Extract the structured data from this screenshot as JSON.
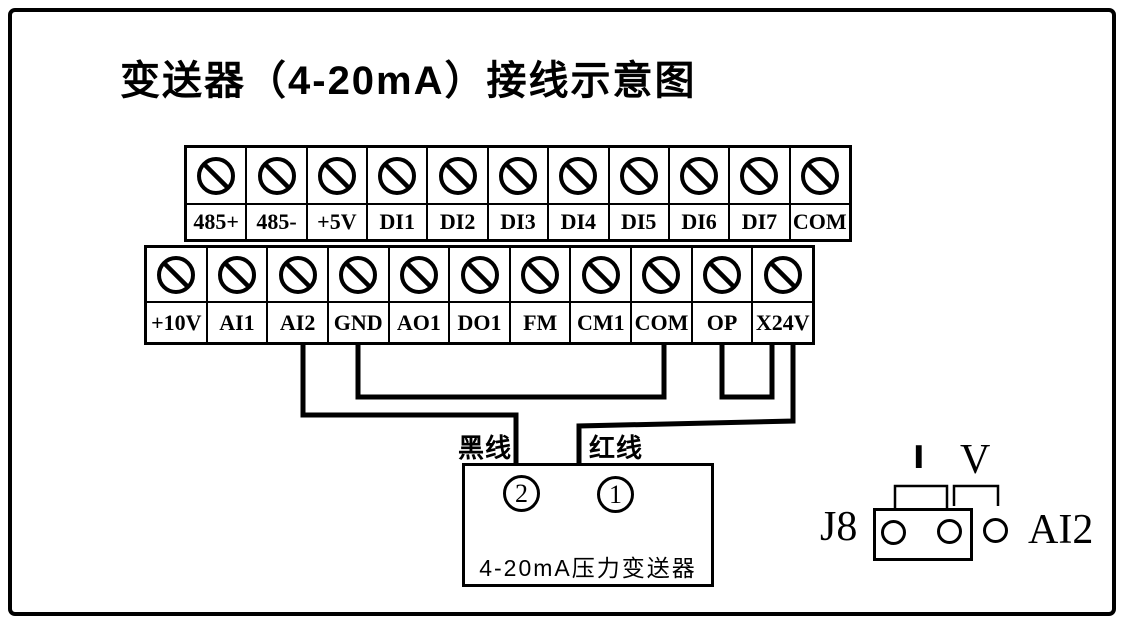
{
  "title": "变送器（4-20mA）接线示意图",
  "colors": {
    "ink": "#000000",
    "paper": "#ffffff"
  },
  "icons": {
    "screw_terminal": "slashed-circle"
  },
  "strips": {
    "top": {
      "labels": [
        "485+",
        "485-",
        "+5V",
        "DI1",
        "DI2",
        "DI3",
        "DI4",
        "DI5",
        "DI6",
        "DI7",
        "COM"
      ]
    },
    "bottom": {
      "labels": [
        "+10V",
        "AI1",
        "AI2",
        "GND",
        "AO1",
        "DO1",
        "FM",
        "CM1",
        "COM",
        "OP",
        "X24V"
      ]
    }
  },
  "wires": {
    "black_label": "黑线",
    "red_label": "红线",
    "connections": [
      {
        "from": "AI2",
        "to": "transmitter-pin-2",
        "wire": "黑线"
      },
      {
        "from": "X24V",
        "to": "transmitter-pin-1",
        "wire": "红线"
      },
      {
        "from": "GND",
        "to": "COM",
        "wire": "jumper"
      },
      {
        "from": "OP",
        "to": "X24V",
        "wire": "jumper"
      }
    ]
  },
  "transmitter": {
    "pin_left": "2",
    "pin_right": "1",
    "name": "4-20mA压力变送器"
  },
  "jumper": {
    "label": "J8",
    "current_label": "I",
    "voltage_label": "V",
    "channel_label": "AI2",
    "pin_count": 3,
    "cap_position": "I"
  }
}
